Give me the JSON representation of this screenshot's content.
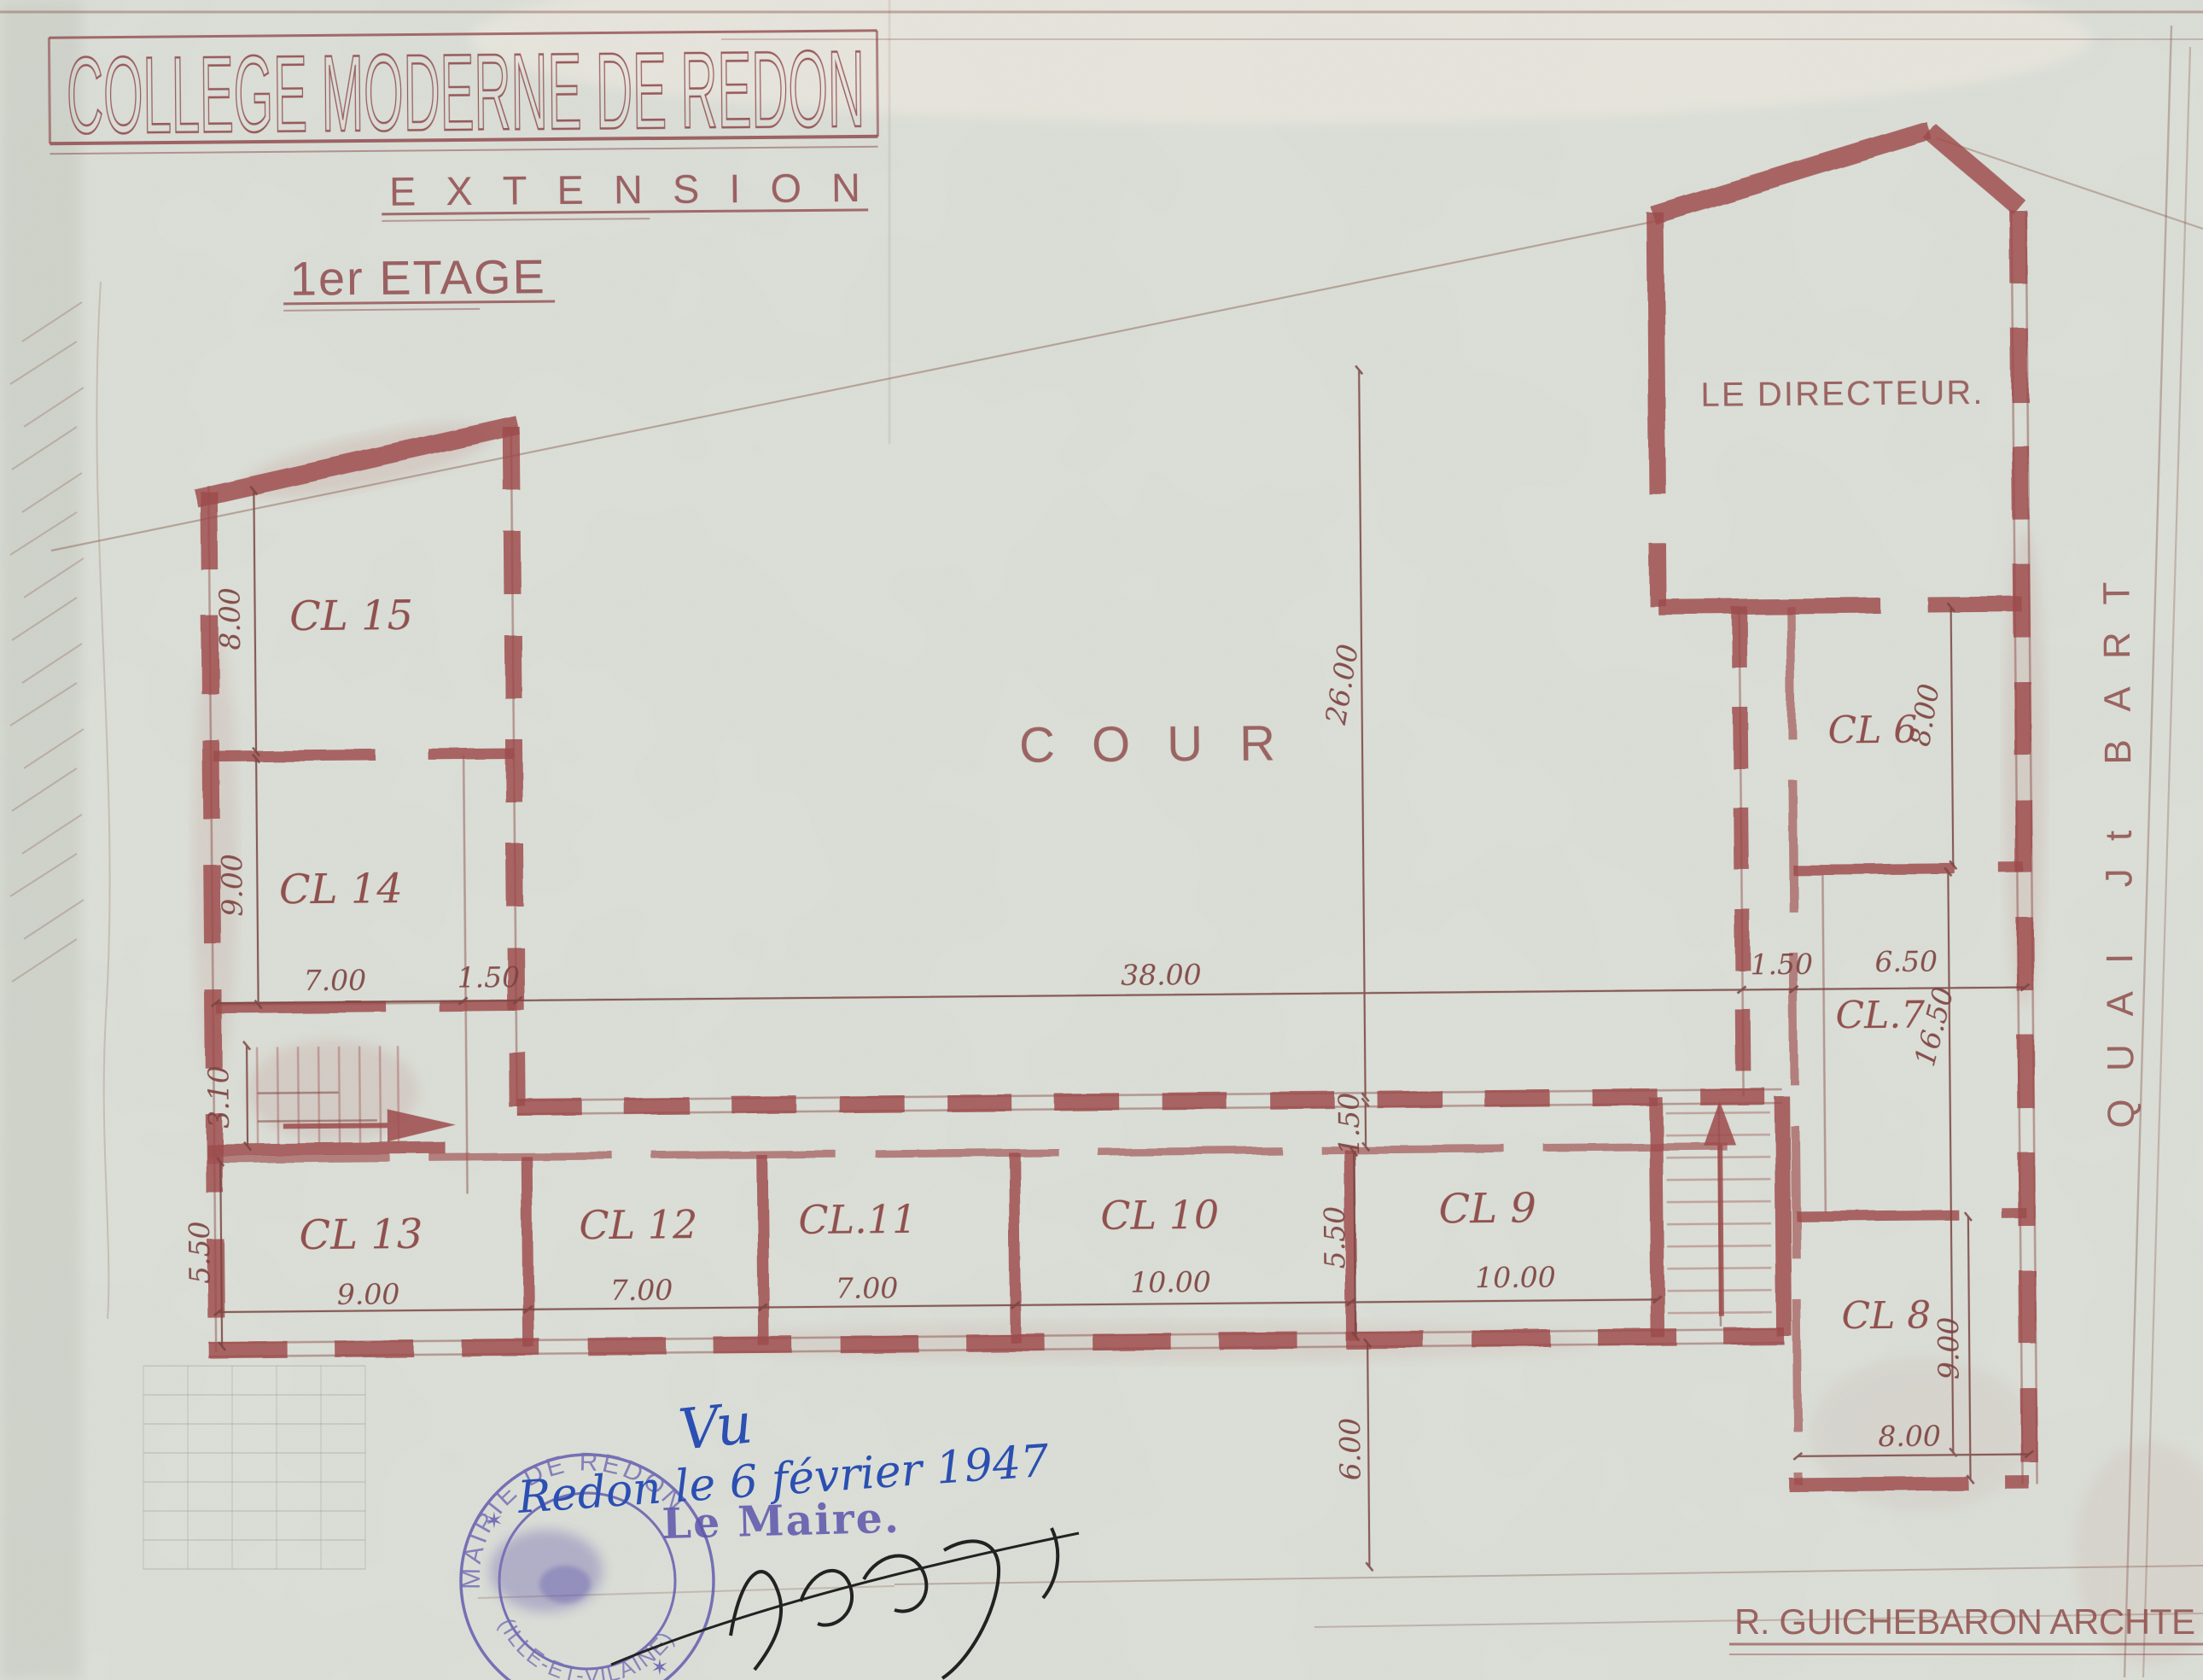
{
  "sheet": {
    "title": "COLLEGE MODERNE DE REDON",
    "subtitle": "EXTENSION",
    "floor_label": "1er ETAGE",
    "courtyard_label": "COUR",
    "street_label": "QUAI Jt BART",
    "architect_signature": "R. GUICHEBARON  ARCHTE"
  },
  "rooms": {
    "directeur": "LE DIRECTEUR.",
    "cl6": "CL 6",
    "cl7": "CL.7",
    "cl8": "CL 8",
    "cl9": "CL 9",
    "cl10": "CL 10",
    "cl11": "CL.11",
    "cl12": "CL 12",
    "cl13": "CL 13",
    "cl14": "CL 14",
    "cl15": "CL 15"
  },
  "dimensions": {
    "cl15_depth": "8.00",
    "cl14_depth": "9.00",
    "stair_hall_width": "3.10",
    "cl13_depth": "5.50",
    "cl14_width": "7.00",
    "wall_gap": "1.50",
    "cour_length": "38.00",
    "cour_depth": "26.00",
    "corridor_width": "1.50",
    "cl9_depth": "5.50",
    "south_offset": "6.00",
    "cl13_width": "9.00",
    "cl12_width": "7.00",
    "cl11_width": "7.00",
    "cl10_width": "10.00",
    "cl9_width": "10.00",
    "right_corridor_width": "1.50",
    "cl7_width": "6.50",
    "right_wing_length": "16.50",
    "cl6_depth": "8.00",
    "cl8_depth": "9.00",
    "cl8_width": "8.00"
  },
  "approval": {
    "vu": "Vu",
    "date_line": "Redon le 6 février 1947",
    "signer_label": "Le Maire.",
    "stamp_ring_top": "MAIRIE DE REDON",
    "stamp_ring_bottom": "(ILLE-ET-VILAINE)",
    "star": "✶"
  },
  "colors": {
    "paper": "#dce0d8",
    "drawing_red": "#9c4a4b",
    "pencil_red": "#7d4340",
    "ink_blue": "#2b4fb2",
    "stamp_violet": "#5c55ac",
    "signature_black": "#222222"
  }
}
